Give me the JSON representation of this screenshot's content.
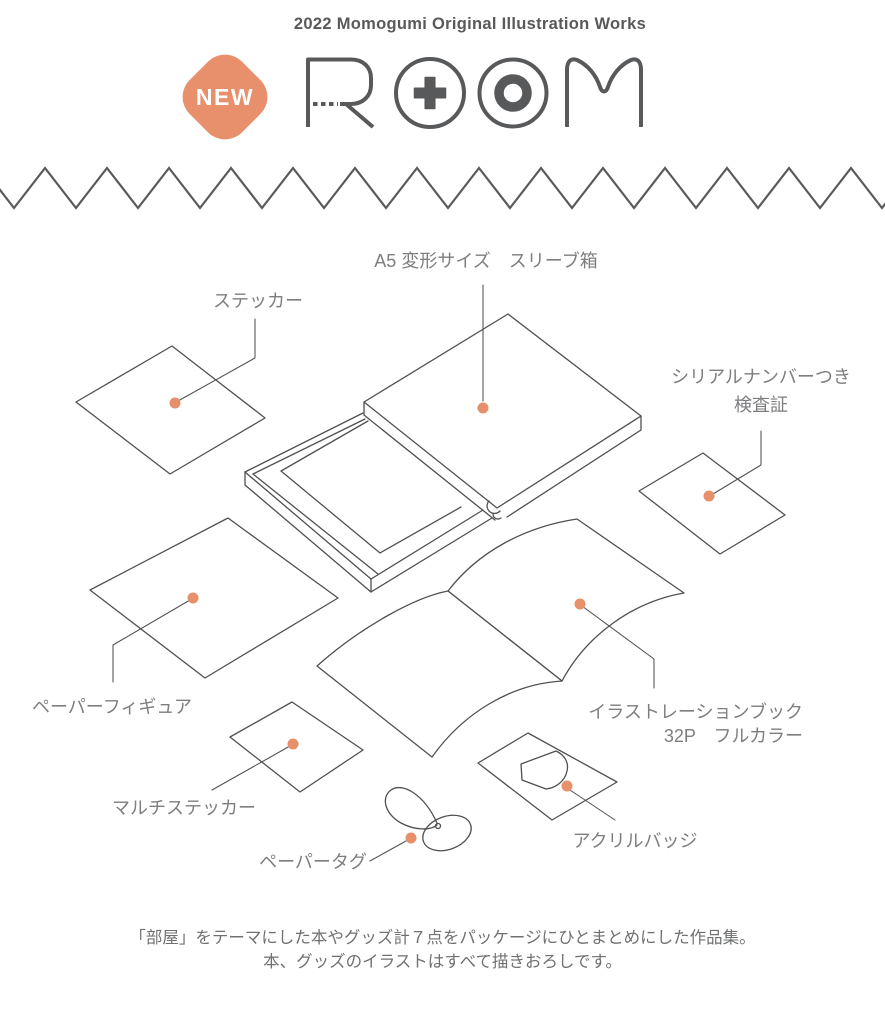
{
  "header": {
    "tagline": "2022 Momogumi Original Illustration Works",
    "badge_label": "NEW",
    "logo_name": "ROOM"
  },
  "items": {
    "sleeve_box": {
      "label": "A5 変形サイズ　スリーブ箱"
    },
    "sticker": {
      "label": "ステッカー"
    },
    "serial_certificate": {
      "label_line1": "シリアルナンバーつき",
      "label_line2": "検査証"
    },
    "paper_figure": {
      "label": "ペーパーフィギュア"
    },
    "illustration_book": {
      "label_line1": "イラストレーションブック",
      "label_line2": "32P　フルカラー"
    },
    "multi_sticker": {
      "label": "マルチステッカー"
    },
    "paper_tag": {
      "label": "ペーパータグ"
    },
    "acrylic_badge": {
      "label": "アクリルバッジ"
    }
  },
  "caption": {
    "line1": "「部屋」をテーマにした本やグッズ計７点をパッケージにひとまとめにした作品集。",
    "line2": "本、グッズのイラストはすべて描きおろしです。"
  },
  "colors": {
    "accent": "#E8906C",
    "line_art": "#4F5052",
    "logo_gray": "#58595B",
    "label_text": "#7D7E80",
    "caption_text": "#6F7072",
    "badge_text": "#FFFFFF"
  }
}
